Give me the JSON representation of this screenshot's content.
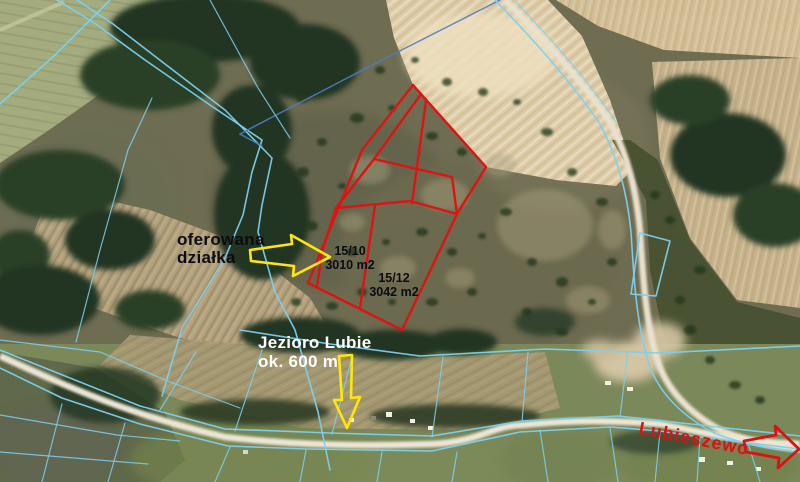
{
  "labels": {
    "offered_plot": {
      "line1": "oferowana",
      "line2": "działka"
    },
    "parcel_a": {
      "id": "15/10",
      "area": "3010 m2"
    },
    "parcel_b": {
      "id": "15/12",
      "area": "3042 m2"
    },
    "lake": {
      "line1": "Jezioro Lubie",
      "line2": "ok. 600 m"
    },
    "village": "Lubieszewo"
  },
  "colors": {
    "cadastral_line": "#7cd0ee",
    "cadastral_dark": "#4d7ec2",
    "parcel_outline": "#e01212",
    "annotation_arrow": "#ffe60a",
    "red_arrow": "#dd1111",
    "offered_text": "#0c0c10",
    "parcel_label_text": "#0c0c10",
    "lake_text": "#ffffff",
    "village_text": "#dd1111"
  }
}
